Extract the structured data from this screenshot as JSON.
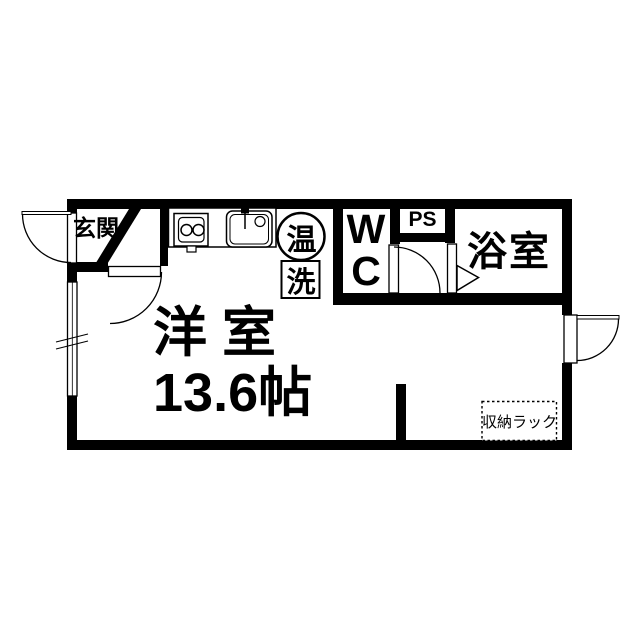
{
  "floorplan": {
    "background_color": "#ffffff",
    "wall_color": "#000000",
    "labels": {
      "entrance": "玄関",
      "water_heater": "温",
      "laundry": "洗",
      "toilet": "WC",
      "pipe_space": "PS",
      "bathroom": "浴室",
      "room_name": "洋 室",
      "room_size": "13.6帖",
      "storage_rack": "収納ラック"
    },
    "icons": [
      {
        "name": "stove-icon",
        "meaning": "two-burner stove"
      },
      {
        "name": "sink-icon",
        "meaning": "kitchen sink with faucet"
      },
      {
        "name": "water-heater-circle-icon",
        "meaning": "water heater"
      },
      {
        "name": "door-swing-arc-icon",
        "meaning": "hinged door swing"
      },
      {
        "name": "folding-door-icon",
        "meaning": "bathroom folding door"
      },
      {
        "name": "window-icon",
        "meaning": "window on exterior wall"
      }
    ]
  }
}
